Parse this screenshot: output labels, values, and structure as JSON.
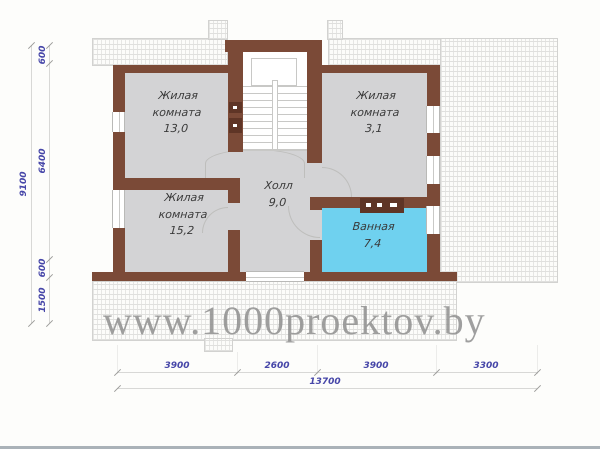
{
  "title": "floor-plan",
  "watermark": "www.1000proektov.by",
  "rooms": {
    "living1": {
      "line1": "Жилая",
      "line2": "комната",
      "area": "13,0"
    },
    "living2": {
      "line1": "Жилая",
      "line2": "комната",
      "area": "3,1"
    },
    "living3": {
      "line1": "Жилая",
      "line2": "комната",
      "area": "15,2"
    },
    "hall": {
      "line1": "Холл",
      "area": "9,0"
    },
    "bath": {
      "line1": "Ванная",
      "area": "7,4"
    }
  },
  "dimensions": {
    "left_outer": "9100",
    "left_chain": [
      "600",
      "6400",
      "600",
      "1500"
    ],
    "bottom_chain": [
      "3900",
      "2600",
      "3900",
      "3300"
    ],
    "bottom_total": "13700"
  },
  "colors": {
    "wall": "#7b4a37",
    "room_fill": "#d3d3d5",
    "bath_fill": "#6fd1ef",
    "dimension_text": "#4646a8",
    "watermark_text": "#8f8f8f"
  }
}
